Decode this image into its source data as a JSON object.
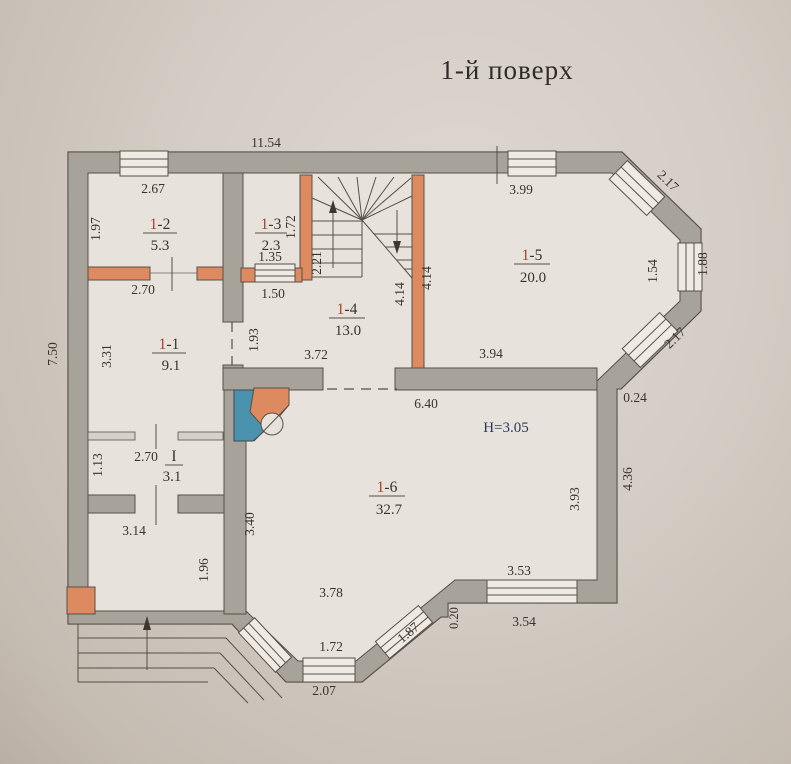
{
  "title": "1-й поверх",
  "rooms": {
    "r11": {
      "prefix": "1",
      "suffix": "-1",
      "area": "9.1"
    },
    "r12": {
      "prefix": "1",
      "suffix": "-2",
      "area": "5.3"
    },
    "r13": {
      "prefix": "1",
      "suffix": "-3",
      "area": "2.3"
    },
    "r14": {
      "prefix": "1",
      "suffix": "-4",
      "area": "13.0"
    },
    "r15": {
      "prefix": "1",
      "suffix": "-5",
      "area": "20.0"
    },
    "r16": {
      "prefix": "1",
      "suffix": "-6",
      "area": "32.7"
    },
    "rI": {
      "prefix": "I",
      "suffix": "",
      "area": "3.1"
    }
  },
  "ceiling_height": "H=3.05",
  "dims": {
    "top_total": "11.54",
    "left_total": "7.50",
    "r12_top": "2.67",
    "r12_left": "1.97",
    "r12_bottom": "2.70",
    "r13_open_top": "1.35",
    "r13_open_bottom": "1.50",
    "r13_right": "1.72",
    "stairs_depth": "2.21",
    "stairs_left": "4.14",
    "stairs_right": "4.14",
    "top_window": "3.99",
    "bevel_top": "2.17",
    "right_window_inner": "1.54",
    "right_window_outer": "1.88",
    "bevel_bottom": "2.17",
    "step_right": "0.24",
    "r11_left": "3.31",
    "r11_open": "1.93",
    "rI_top": "2.70",
    "rI_left": "1.13",
    "hall_top": "3.14",
    "hall_right": "1.96",
    "r14_bottom": "3.72",
    "r15_bottom": "3.94",
    "r16_top": "6.40",
    "r16_left": "3.40",
    "r16_right": "3.93",
    "right_lower_outer": "4.36",
    "bottom_inner": "3.53",
    "bottom_outer": "3.54",
    "bottom_step": "0.20",
    "bay_diag": "1.87",
    "bay_inner": "1.72",
    "bay_outer": "2.07",
    "bay_top": "3.78"
  },
  "colors": {
    "wall_gray": "#a7a29a",
    "partition_orange": "#dd8a60",
    "fireplace_blue": "#4a92ae",
    "room_number_red": "#a8402b",
    "height_label_blue": "#2b3a5c"
  }
}
